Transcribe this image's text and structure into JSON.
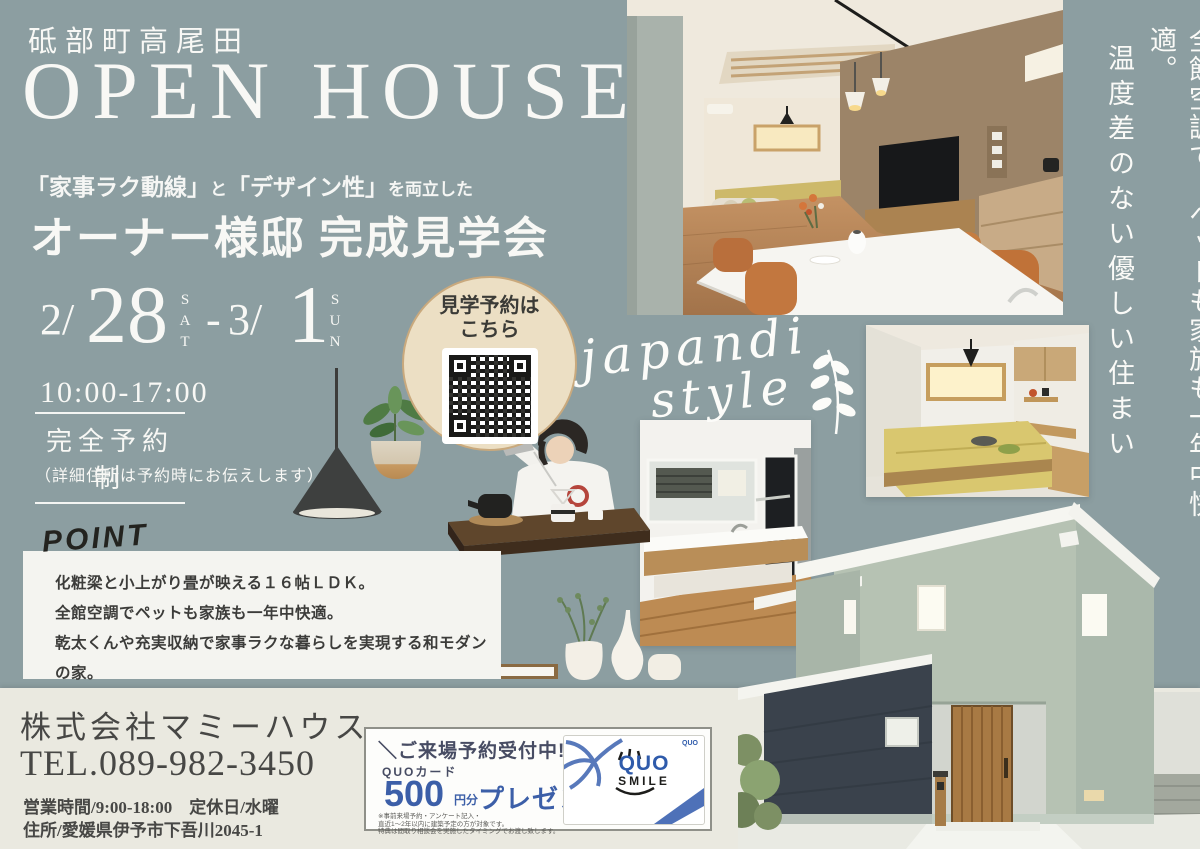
{
  "colors": {
    "background": "#8C9EA1",
    "footer_strip": "#EAE9E0",
    "text_light": "#F8F8F5",
    "text_dark": "#3C3C3A",
    "point_box_bg": "#F4F4F0",
    "qr_circle_bg": "#ECDFC4",
    "qr_circle_border": "#C9A97D",
    "campaign_navy": "#474C63",
    "campaign_blue": "#3C5FA8"
  },
  "header": {
    "location": "砥部町高尾田",
    "title": "OPEN HOUSE",
    "subtitle_parts": [
      "「家事ラク動線」",
      "と",
      "「デザイン性」",
      "を両立した"
    ],
    "event_title": "オーナー様邸 完成見学会"
  },
  "schedule": {
    "start_month": "2/",
    "start_day": "28",
    "start_weekday": "SAT",
    "separator": "-",
    "end_month": "3/",
    "end_day": "1",
    "end_weekday": "SUN",
    "hours": "10:00-17:00",
    "reservation_label": "完全予約制",
    "address_note": "（詳細住所は予約時にお伝えします）"
  },
  "point": {
    "label": "POINT",
    "lines": [
      "化粧梁と小上がり畳が映える１６帖ＬＤＫ。",
      "全館空調でペットも家族も一年中快適。",
      "乾太くんや充実収納で家事ラクな暮らしを実現する和モダンの家。"
    ]
  },
  "qr": {
    "label_line1": "見学予約は",
    "label_line2": "こちら"
  },
  "style_note": {
    "word1": "japandi",
    "word2": "style"
  },
  "vertical_copy": {
    "line1": "全館空調で、ペットも家族も一年中快適。",
    "line2": "温度差のない優しい住まい"
  },
  "company": {
    "name": "株式会社マミーハウス",
    "tel": "TEL.089-982-3450",
    "hours": "営業時間/9:00-18:00　定休日/水曜",
    "address": "住所/愛媛県伊予市下吾川2045-1"
  },
  "campaign": {
    "headline": "＼ご来場予約受付中!／",
    "item": "QUOカード",
    "amount": "500",
    "unit": "円分",
    "present": "プレゼント",
    "fine_print": [
      "※事前来場予約・アンケート記入・",
      "直近1～2年以内に建築予定の方が対象です。",
      "特典は間取り相談会を実施したタイミングでお渡し致します。"
    ],
    "card": {
      "brand": "QUO",
      "smile": "SMILE"
    }
  }
}
